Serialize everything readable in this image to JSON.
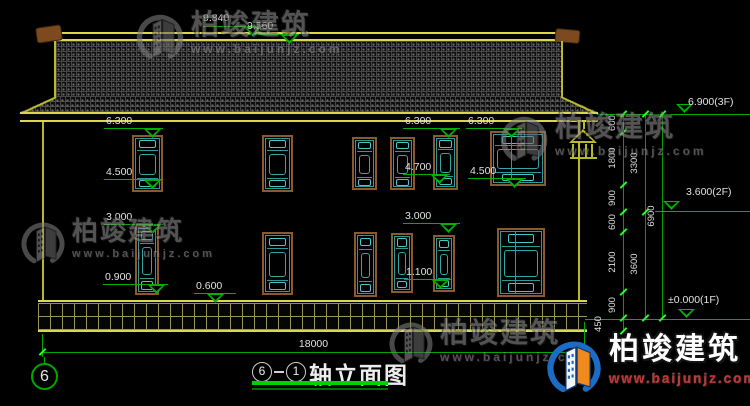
{
  "watermark": {
    "brand": "柏竣建筑",
    "url": "www.baijunjz.com",
    "gray": "#8d8d8d"
  },
  "logo": {
    "brand": "柏竣建筑",
    "url": "www.baijunjz.com",
    "blue": "#1a6cc4",
    "orange": "#f08a1c",
    "light": "#f2f5fa",
    "outline": "#123c78",
    "red": "#c23333"
  },
  "title": {
    "axis_start": "6",
    "axis_end": "1",
    "text": "轴立面图",
    "grid_bubble": "6"
  },
  "drawing": {
    "total_width_label": "18000",
    "spot_markers": [
      {
        "label": "9.840",
        "tx": 203,
        "ty": 12,
        "lx1": 203,
        "lx2": 262,
        "ly": 26,
        "trix": 244,
        "tridir": "below"
      },
      {
        "label": "9.560",
        "tx": 247,
        "ty": 20,
        "lx1": 247,
        "lx2": 299,
        "ly": 34,
        "trix": 281,
        "tridir": "below"
      },
      {
        "label": "6.300",
        "tx": 106,
        "ty": 115,
        "lx1": 104,
        "lx2": 163,
        "ly": 128,
        "trix": 144,
        "tridir": "below"
      },
      {
        "label": "4.500",
        "tx": 106,
        "ty": 166,
        "lx1": 104,
        "lx2": 163,
        "ly": 179,
        "trix": 144,
        "tridir": "below"
      },
      {
        "label": "3.000",
        "tx": 106,
        "ty": 211,
        "lx1": 104,
        "lx2": 163,
        "ly": 224,
        "trix": 144,
        "tridir": "below"
      },
      {
        "label": "0.900",
        "tx": 105,
        "ty": 271,
        "lx1": 103,
        "lx2": 168,
        "ly": 284,
        "trix": 148,
        "tridir": "below"
      },
      {
        "label": "0.600",
        "tx": 196,
        "ty": 280,
        "lx1": 194,
        "lx2": 236,
        "ly": 293,
        "trix": 207,
        "tridir": "below"
      },
      {
        "label": "6.300",
        "tx": 405,
        "ty": 115,
        "lx1": 403,
        "lx2": 460,
        "ly": 128,
        "trix": 440,
        "tridir": "below"
      },
      {
        "label": "6.300",
        "tx": 468,
        "ty": 115,
        "lx1": 466,
        "lx2": 523,
        "ly": 128,
        "trix": 503,
        "tridir": "below"
      },
      {
        "label": "4.700",
        "tx": 405,
        "ty": 161,
        "lx1": 403,
        "lx2": 450,
        "ly": 174,
        "trix": 431,
        "tridir": "below"
      },
      {
        "label": "4.500",
        "tx": 470,
        "ty": 165,
        "lx1": 468,
        "lx2": 526,
        "ly": 178,
        "trix": 506,
        "tridir": "below"
      },
      {
        "label": "3.000",
        "tx": 405,
        "ty": 210,
        "lx1": 403,
        "lx2": 460,
        "ly": 223,
        "trix": 440,
        "tridir": "below"
      },
      {
        "label": "1.100",
        "tx": 406,
        "ty": 266,
        "lx1": 404,
        "lx2": 451,
        "ly": 279,
        "trix": 432,
        "tridir": "below"
      },
      {
        "label": "6.900(3F)",
        "tx": 688,
        "ty": 96,
        "lx1": 597,
        "lx2": 750,
        "ly": 114,
        "trix": 676,
        "tridir": "above"
      },
      {
        "label": "3.600(2F)",
        "tx": 686,
        "ty": 186,
        "lx1": 655,
        "lx2": 750,
        "ly": 211,
        "trix": 663,
        "tridir": "above"
      },
      {
        "label": "±0.000(1F)",
        "tx": 668,
        "ty": 294,
        "lx1": 585,
        "lx2": 750,
        "ly": 319,
        "trix": 678,
        "tridir": "above"
      }
    ],
    "chains": [
      {
        "x": 623,
        "y1": 114,
        "y2": 331,
        "ticks": [
          114,
          132,
          185,
          212,
          232,
          292,
          318,
          331
        ],
        "labels": [
          {
            "t": "600",
            "y": 123
          },
          {
            "t": "1800",
            "y": 158
          },
          {
            "t": "900",
            "y": 198
          },
          {
            "t": "600",
            "y": 222
          },
          {
            "t": "2100",
            "y": 262
          },
          {
            "t": "900",
            "y": 305
          },
          {
            "t": "450",
            "y": 324,
            "dx": -14
          }
        ]
      },
      {
        "x": 645,
        "y1": 114,
        "y2": 318,
        "ticks": [
          114,
          212,
          318
        ],
        "labels": [
          {
            "t": "3300",
            "y": 163
          },
          {
            "t": "3600",
            "y": 264
          }
        ]
      },
      {
        "x": 662,
        "y1": 114,
        "y2": 318,
        "ticks": [
          114,
          318
        ],
        "labels": [
          {
            "t": "6900",
            "y": 216
          }
        ]
      }
    ],
    "windows": [
      {
        "x": 132,
        "y": 135,
        "w": 31,
        "h": 57
      },
      {
        "x": 262,
        "y": 135,
        "w": 31,
        "h": 57
      },
      {
        "x": 352,
        "y": 137,
        "w": 25,
        "h": 53
      },
      {
        "x": 390,
        "y": 137,
        "w": 25,
        "h": 53
      },
      {
        "x": 433,
        "y": 135,
        "w": 25,
        "h": 55
      },
      {
        "x": 490,
        "y": 131,
        "w": 56,
        "h": 55,
        "div": true
      },
      {
        "x": 135,
        "y": 225,
        "w": 24,
        "h": 70
      },
      {
        "x": 262,
        "y": 232,
        "w": 31,
        "h": 63
      },
      {
        "x": 354,
        "y": 232,
        "w": 23,
        "h": 65
      },
      {
        "x": 391,
        "y": 233,
        "w": 22,
        "h": 60
      },
      {
        "x": 433,
        "y": 235,
        "w": 22,
        "h": 57
      },
      {
        "x": 497,
        "y": 228,
        "w": 48,
        "h": 69,
        "div": true
      }
    ]
  }
}
